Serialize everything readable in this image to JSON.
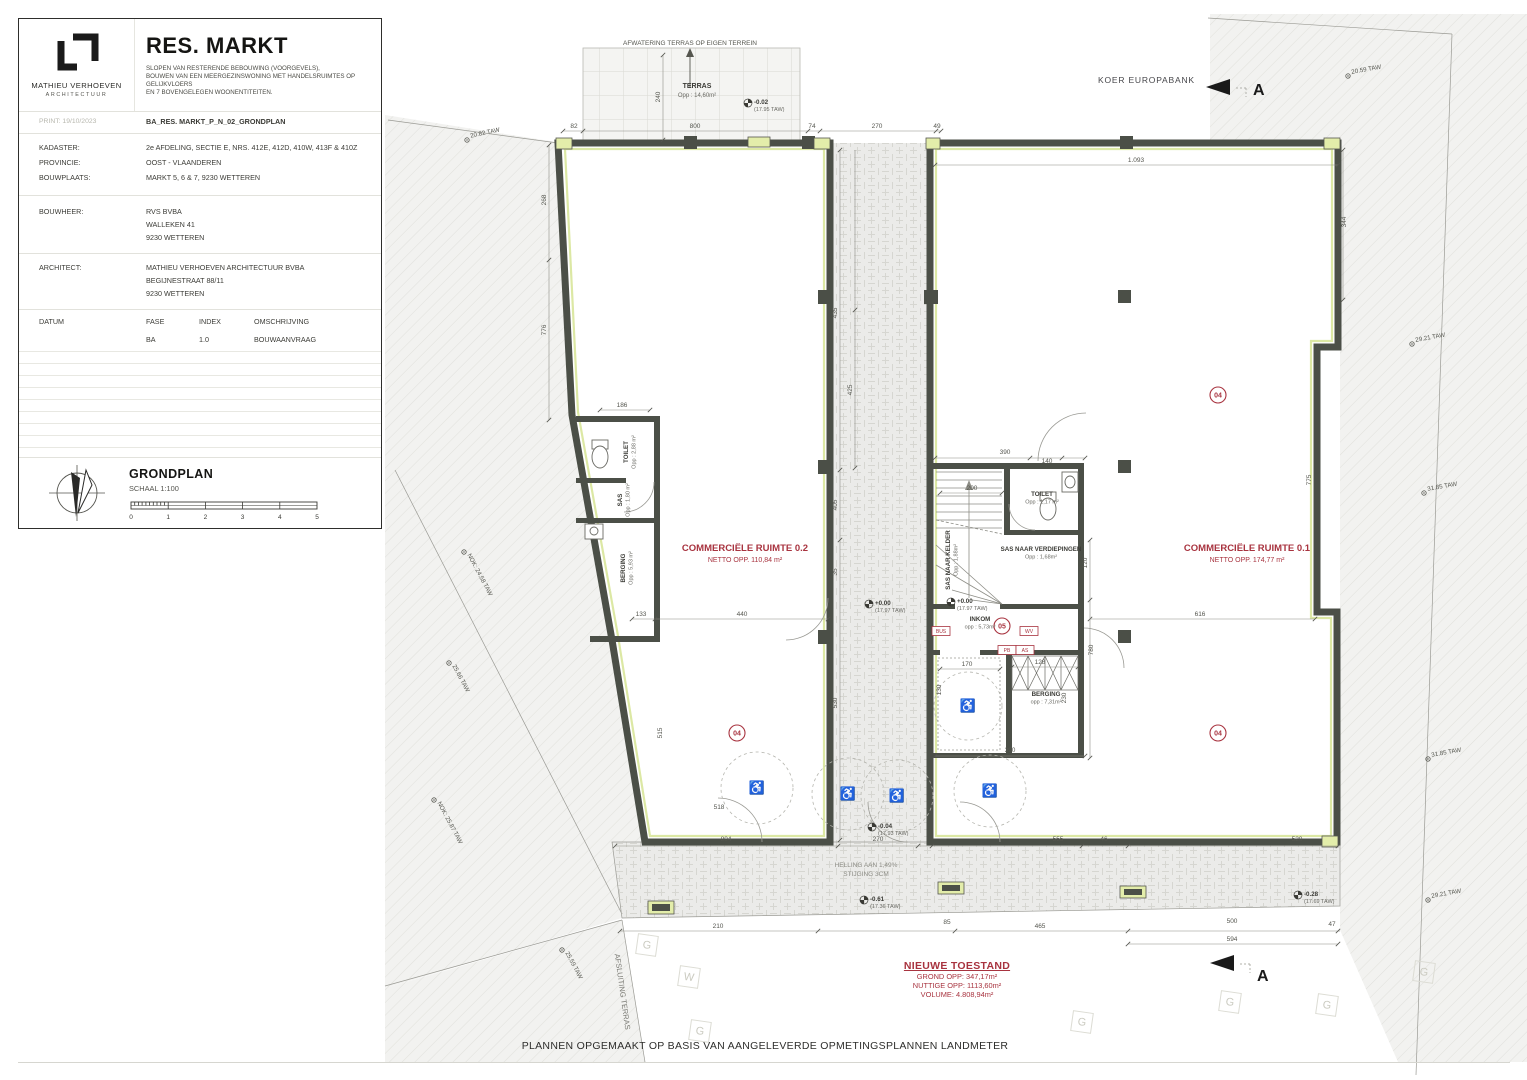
{
  "titleblock": {
    "logo_name": "MATHIEU VERHOEVEN",
    "logo_sub": "ARCHITECTUUR",
    "project_title": "RES. MARKT",
    "description_lines": [
      "SLOPEN VAN RESTERENDE BEBOUWING (VOORGEVELS),",
      "BOUWEN VAN EEN MEERGEZINSWONING MET HANDELSRUIMTES OP GELIJKVLOERS",
      "EN 7 BOVENGELEGEN WOONENTITEITEN."
    ],
    "print_label": "PRINT: 19/10/2023",
    "drawing_code": "BA_RES. MARKT_P_N_02_GRONDPLAN",
    "rows": [
      {
        "label": "KADASTER:",
        "value": "2e AFDELING, SECTIE E, NRS. 412E, 412D, 410W, 413F & 410Z"
      },
      {
        "label": "PROVINCIE:",
        "value": "OOST - VLAANDEREN"
      },
      {
        "label": "BOUWPLAATS:",
        "value": "MARKT 5, 6 & 7, 9230 WETTEREN"
      }
    ],
    "bouwheer_label": "BOUWHEER:",
    "bouwheer_lines": [
      "RVS BVBA",
      "WALLEKEN 41",
      "9230 WETTEREN"
    ],
    "architect_label": "ARCHITECT:",
    "architect_lines": [
      "MATHIEU VERHOEVEN ARCHITECTUUR BVBA",
      "BEGIJNESTRAAT 88/11",
      "9230 WETTEREN"
    ],
    "table_headers": [
      "DATUM",
      "FASE",
      "INDEX",
      "OMSCHRIJVING"
    ],
    "table_row": {
      "fase": "BA",
      "index": "1.0",
      "omschrijving": "BOUWAANVRAAG"
    },
    "plan_name": "GRONDPLAN",
    "plan_scale": "SCHAAL 1:100",
    "scalebar": [
      "0",
      "1",
      "2",
      "3",
      "4",
      "5"
    ]
  },
  "plan": {
    "colors": {
      "wall": "#4b4f47",
      "lining": "#dce8a4",
      "red": "#a8333f",
      "hatch_bg": "#f2f2f0"
    },
    "icons": {
      "wheelchair": "♿"
    },
    "top": {
      "afwatering": "AFWATERING TERRAS OP EIGEN TERREIN",
      "terras_label": "TERRAS",
      "terras_opp": "Opp : 14,60m²",
      "koer": "KOER EUROPABANK",
      "section_letter": "A"
    },
    "rooms": [
      {
        "name": "COMMERCIËLE RUIMTE 0.2",
        "sub": "NETTO OPP. 110,84 m²",
        "x": 745,
        "y": 551
      },
      {
        "name": "COMMERCIËLE RUIMTE 0.1",
        "sub": "NETTO OPP. 174,77 m²",
        "x": 1247,
        "y": 551
      }
    ],
    "small_rooms": [
      {
        "t": "TOILET",
        "s": "Opp : 2,88 m²",
        "x": 628,
        "y": 452,
        "r": -90
      },
      {
        "t": "SAS",
        "s": "Opp : 1,80 m²",
        "x": 622,
        "y": 500,
        "r": -90
      },
      {
        "t": "BERGING",
        "s": "Opp : 5,93 m²",
        "x": 625,
        "y": 568,
        "r": -90
      },
      {
        "t": "SAS NAAR KELDER",
        "s": "Opp : 1,88m²",
        "x": 950,
        "y": 560,
        "r": -90
      },
      {
        "t": "SAS NAAR VERDIEPINGEN",
        "s": "Opp : 1,68m²",
        "x": 1041,
        "y": 551,
        "r": 0
      },
      {
        "t": "TOILET",
        "s": "Opp : 1,17 m²",
        "x": 1042,
        "y": 496,
        "r": 0
      },
      {
        "t": "INKOM",
        "s": "opp : 5,73m²",
        "x": 980,
        "y": 621,
        "r": 0
      },
      {
        "t": "BERGING",
        "s": "opp : 7,31m²",
        "x": 1046,
        "y": 696,
        "r": 0
      }
    ],
    "levels": [
      {
        "m": "-0.02",
        "s": "(17.95 TAW)",
        "x": 748,
        "y": 103
      },
      {
        "m": "+0.00",
        "s": "(17.97 TAW)",
        "x": 869,
        "y": 604
      },
      {
        "m": "+0.00",
        "s": "(17.97 TAW)",
        "x": 951,
        "y": 602
      },
      {
        "m": "-0.04",
        "s": "(17.93 TAW)",
        "x": 872,
        "y": 827
      },
      {
        "m": "-0.61",
        "s": "(17.36 TAW)",
        "x": 864,
        "y": 900
      },
      {
        "m": "-0.28",
        "s": "(17.69 TAW)",
        "x": 1298,
        "y": 895
      }
    ],
    "taw_marks": [
      {
        "t": "20.82 TAW",
        "x": 467,
        "y": 140,
        "r": -12
      },
      {
        "t": "20.59 TAW",
        "x": 1348,
        "y": 76,
        "r": -10
      },
      {
        "t": "29.21 TAW",
        "x": 1412,
        "y": 344,
        "r": -10
      },
      {
        "t": "31.85 TAW",
        "x": 1424,
        "y": 493,
        "r": -10
      },
      {
        "t": "31.85 TAW",
        "x": 1428,
        "y": 759,
        "r": -10
      },
      {
        "t": "29.21 TAW",
        "x": 1428,
        "y": 900,
        "r": -10
      },
      {
        "t": "NOK: 24.58 TAW",
        "x": 464,
        "y": 552,
        "r": 62
      },
      {
        "t": "25.66 TAW",
        "x": 449,
        "y": 663,
        "r": 62
      },
      {
        "t": "NOK: 25.87 TAW",
        "x": 434,
        "y": 800,
        "r": 62
      },
      {
        "t": "25.59 TAW",
        "x": 562,
        "y": 950,
        "r": 62
      }
    ],
    "dims": [
      {
        "t": "82",
        "x": 574,
        "y": 128
      },
      {
        "t": "800",
        "x": 695,
        "y": 128
      },
      {
        "t": "74",
        "x": 812,
        "y": 128
      },
      {
        "t": "270",
        "x": 877,
        "y": 128
      },
      {
        "t": "49",
        "x": 937,
        "y": 128
      },
      {
        "t": "1.093",
        "x": 1136,
        "y": 162
      },
      {
        "t": "268",
        "x": 546,
        "y": 200,
        "r": -90
      },
      {
        "t": "776",
        "x": 546,
        "y": 330,
        "r": -90
      },
      {
        "t": "240",
        "x": 660,
        "y": 97,
        "r": -90
      },
      {
        "t": "435",
        "x": 837,
        "y": 313,
        "r": -90
      },
      {
        "t": "425",
        "x": 852,
        "y": 390,
        "r": -90
      },
      {
        "t": "405",
        "x": 837,
        "y": 505,
        "r": -90
      },
      {
        "t": "35",
        "x": 837,
        "y": 572,
        "r": -90
      },
      {
        "t": "530",
        "x": 837,
        "y": 703,
        "r": -90
      },
      {
        "t": "186",
        "x": 622,
        "y": 407
      },
      {
        "t": "133",
        "x": 641,
        "y": 616
      },
      {
        "t": "440",
        "x": 742,
        "y": 616
      },
      {
        "t": "515",
        "x": 662,
        "y": 733,
        "r": -90
      },
      {
        "t": "518",
        "x": 719,
        "y": 809
      },
      {
        "t": "390",
        "x": 1005,
        "y": 454
      },
      {
        "t": "140",
        "x": 1047,
        "y": 463
      },
      {
        "t": "200",
        "x": 972,
        "y": 490
      },
      {
        "t": "170",
        "x": 967,
        "y": 666
      },
      {
        "t": "128",
        "x": 1040,
        "y": 664
      },
      {
        "t": "130",
        "x": 941,
        "y": 690,
        "r": -90
      },
      {
        "t": "230",
        "x": 1066,
        "y": 698,
        "r": -90
      },
      {
        "t": "390",
        "x": 1010,
        "y": 752
      },
      {
        "t": "120",
        "x": 1087,
        "y": 563,
        "r": -90
      },
      {
        "t": "780",
        "x": 1093,
        "y": 650,
        "r": -90
      },
      {
        "t": "616",
        "x": 1200,
        "y": 616
      },
      {
        "t": "344",
        "x": 1346,
        "y": 222,
        "r": -90
      },
      {
        "t": "775",
        "x": 1311,
        "y": 480,
        "r": -90
      },
      {
        "t": "804",
        "x": 726,
        "y": 841
      },
      {
        "t": "270",
        "x": 878,
        "y": 841
      },
      {
        "t": "555",
        "x": 1058,
        "y": 841
      },
      {
        "t": "46",
        "x": 1104,
        "y": 841
      },
      {
        "t": "520",
        "x": 1297,
        "y": 841
      },
      {
        "t": "210",
        "x": 718,
        "y": 928
      },
      {
        "t": "85",
        "x": 947,
        "y": 924
      },
      {
        "t": "465",
        "x": 1040,
        "y": 928
      },
      {
        "t": "500",
        "x": 1232,
        "y": 923
      },
      {
        "t": "47",
        "x": 1332,
        "y": 926
      },
      {
        "t": "594",
        "x": 1232,
        "y": 941
      }
    ],
    "tags_circled": [
      {
        "t": "04",
        "x": 737,
        "y": 733
      },
      {
        "t": "04",
        "x": 1218,
        "y": 395
      },
      {
        "t": "04",
        "x": 1218,
        "y": 733
      },
      {
        "t": "05",
        "x": 1002,
        "y": 626
      }
    ],
    "tags_boxed": [
      {
        "t": "BUS",
        "x": 941,
        "y": 631
      },
      {
        "t": "WV",
        "x": 1029,
        "y": 631
      },
      {
        "t": "PB",
        "x": 1007,
        "y": 650
      },
      {
        "t": "AS",
        "x": 1025,
        "y": 650
      }
    ],
    "utilities": [
      {
        "t": "G",
        "x": 647,
        "y": 945
      },
      {
        "t": "W",
        "x": 689,
        "y": 977
      },
      {
        "t": "G",
        "x": 700,
        "y": 1031
      },
      {
        "t": "G",
        "x": 1082,
        "y": 1022
      },
      {
        "t": "G",
        "x": 1230,
        "y": 1002
      },
      {
        "t": "G",
        "x": 1327,
        "y": 1005
      },
      {
        "t": "G",
        "x": 1424,
        "y": 972
      }
    ],
    "helling": {
      "l1": "HELLING AAN 1,49%",
      "l2": "STIJGING 3CM"
    },
    "afsluiting": "AFSLUITING TERRAS"
  },
  "nieuwe_toestand": {
    "title": "NIEUWE TOESTAND",
    "lines": [
      "GROND OPP: 347,17m²",
      "NUTTIGE OPP: 1113,60m²",
      "VOLUME: 4.808,94m²"
    ]
  },
  "footer_note": "PLANNEN OPGEMAAKT OP BASIS VAN AANGELEVERDE OPMETINGSPLANNEN LANDMETER"
}
